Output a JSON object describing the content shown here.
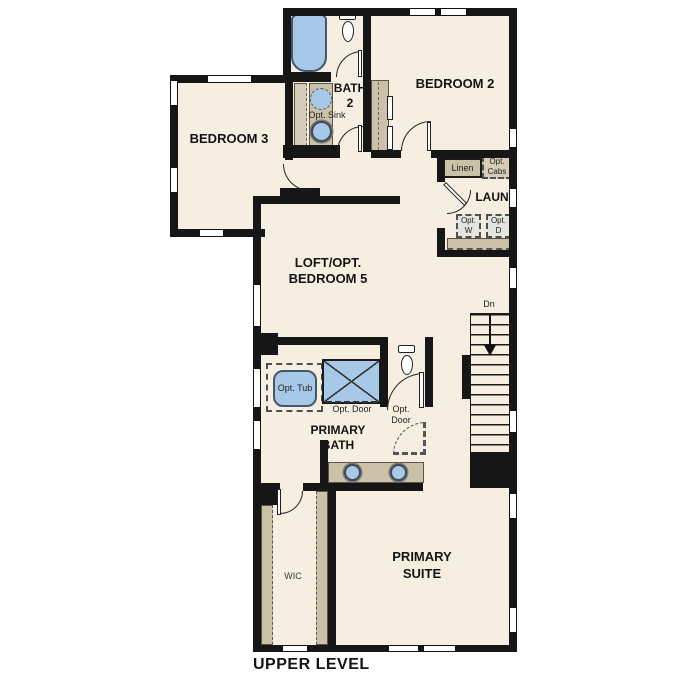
{
  "plan": {
    "title": "UPPER LEVEL",
    "rooms": {
      "bedroom2": "BEDROOM 2",
      "bedroom3": "BEDROOM 3",
      "bath2_l1": "BATH",
      "bath2_l2": "2",
      "loft_l1": "LOFT/OPT.",
      "loft_l2": "BEDROOM 5",
      "laundry": "LAUN",
      "primary_bath_l1": "PRIMARY",
      "primary_bath_l2": "BATH",
      "primary_suite_l1": "PRIMARY",
      "primary_suite_l2": "SUITE",
      "wic": "WIC"
    },
    "features": {
      "opt_sink": "Opt. Sink",
      "linen": "Linen",
      "opt_cabs_l1": "Opt.",
      "opt_cabs_l2": "Cabs",
      "opt_w_l1": "Opt.",
      "opt_w_l2": "W",
      "opt_d_l1": "Opt.",
      "opt_d_l2": "D",
      "opt_tub": "Opt. Tub",
      "opt_door_shower": "Opt. Door",
      "opt_door_suite_l1": "Opt.",
      "opt_door_suite_l2": "Door",
      "down": "Dn"
    },
    "colors": {
      "floor": "#f6efe1",
      "wall": "#161616",
      "fixture_blue": "#a8c8e8",
      "cabinet_tan": "#cbc0a8",
      "cabinet_tan_light": "#d7cdb7",
      "appliance_grey": "#e3e5e1"
    }
  }
}
